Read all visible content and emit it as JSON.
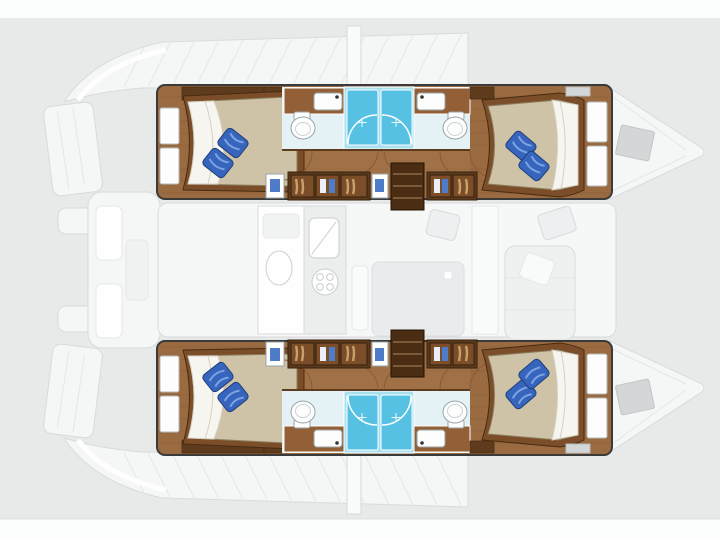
{
  "meta": {
    "kind": "yacht-floor-plan",
    "subject": "catamaran layout, top view, bows to the right",
    "visible_text": []
  },
  "canvas": {
    "width": 720,
    "height": 540
  },
  "colors": {
    "page_bg": "#e8eaea",
    "margin_strip": "#fcfdfd",
    "hull_outline": "#3a3a3a",
    "wood_floor": "#9a6a40",
    "wood_mid": "#8a5a34",
    "wood_light": "#a5764a",
    "wood_dark": "#5f3b1d",
    "wood_trim": "#7b4e29",
    "stair_wood": "#4a2d12",
    "mattress": "#cec2a7",
    "mattress_line": "#8c7d5e",
    "sheet": "#f7f5ef",
    "sheet_line": "#d5d0c2",
    "pillow_blue": "#3765bd",
    "pillow_light": "#7da3e0",
    "pillow_edge": "#1e3f7a",
    "shower_cyan": "#56c1e2",
    "shower_pale": "#a9e0f0",
    "bath_floor": "#e4f1f5",
    "fixture_white": "#fdfdfd",
    "fixture_line": "#98a4a8",
    "clothes_tan": "#caa06a",
    "clothes_white": "#e9eef7",
    "clothes_blue": "#4f7cc9",
    "ghost_fill": "#f6f7f7",
    "ghost_line": "#d7dadb",
    "ghost_detail": "#e5e8e8",
    "hatch_gray": "#d2d6d6"
  },
  "scene": {
    "highlighted_sections": [
      "port-hull",
      "starboard-hull"
    ],
    "hull_rooms": [
      "aft-double-cabin",
      "aft-head",
      "shower-stall",
      "wardrobes",
      "companionway-steps",
      "fwd-head",
      "forward-double-cabin"
    ],
    "pillows_per_bed": 2,
    "shower_stalls_per_hull": 2,
    "ghosted_features": [
      "transom-platforms",
      "aft-cockpit",
      "side-decks",
      "mast-post",
      "salon-galley-sink",
      "galley-stove",
      "salon-table",
      "salon-sofa",
      "nav-seats",
      "bow-deck-hatches"
    ]
  }
}
